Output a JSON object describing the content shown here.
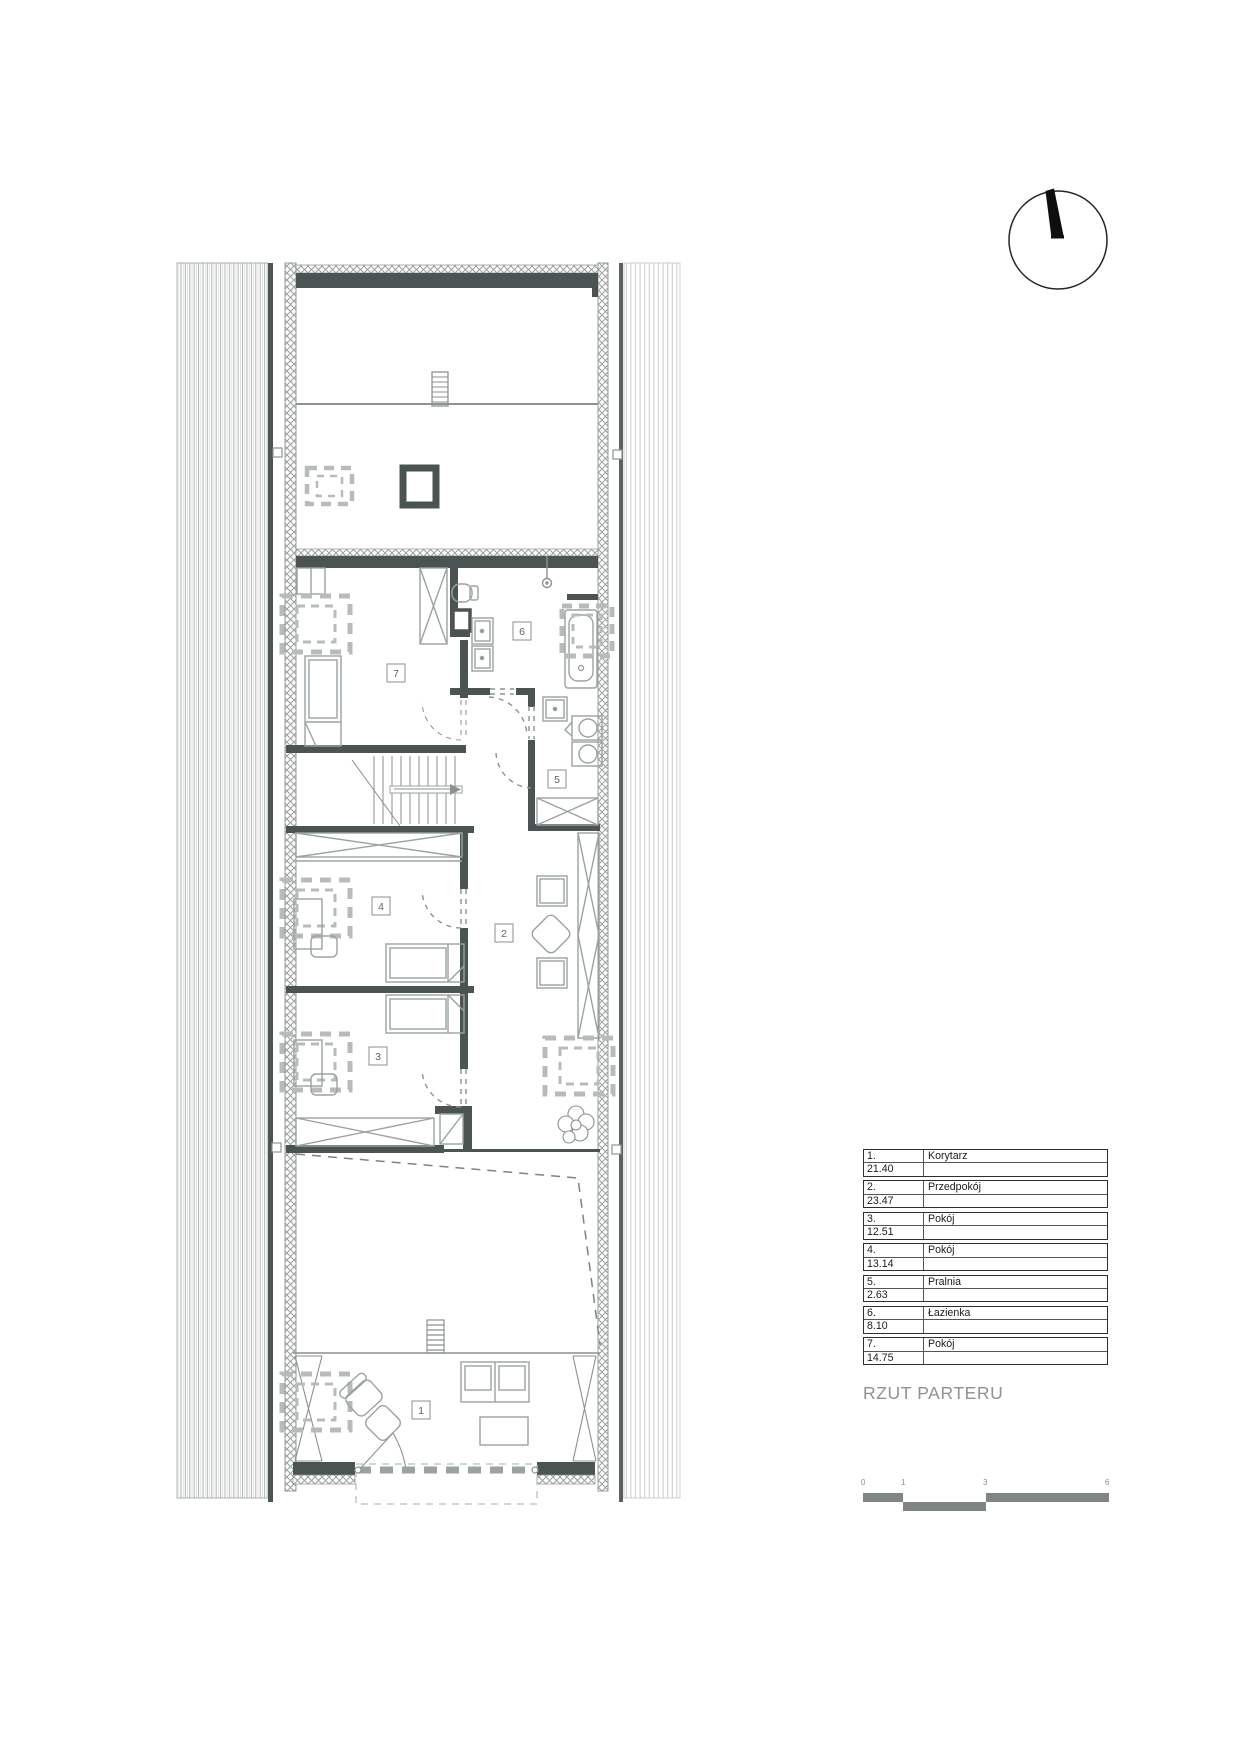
{
  "title": "RZUT PARTERU",
  "legend": {
    "rooms": [
      {
        "num": "1.",
        "name": "Korytarz",
        "area": "21.40"
      },
      {
        "num": "2.",
        "name": "Przedpokój",
        "area": "23.47"
      },
      {
        "num": "3.",
        "name": "Pokój",
        "area": "12.51"
      },
      {
        "num": "4.",
        "name": "Pokój",
        "area": "13.14"
      },
      {
        "num": "5.",
        "name": "Pralnia",
        "area": "2.63"
      },
      {
        "num": "6.",
        "name": "Łazienka",
        "area": "8.10"
      },
      {
        "num": "7.",
        "name": "Pokój",
        "area": "14.75"
      }
    ]
  },
  "plan": {
    "room_labels": {
      "r1": "1",
      "r2": "2",
      "r3": "3",
      "r4": "4",
      "r5": "5",
      "r6": "6",
      "r7": "7"
    }
  },
  "scale_bar": {
    "labels": [
      "0",
      "1",
      "3",
      "6"
    ]
  },
  "compass": {
    "type": "north-arrow"
  },
  "colors": {
    "wall": "#4c5453",
    "furniture_line": "#9aa3a1",
    "window_symbol": "#b7bcbb",
    "hatch": "#9aa09f",
    "title_gray": "#8e9392",
    "scale_gray": "#7e8584"
  }
}
